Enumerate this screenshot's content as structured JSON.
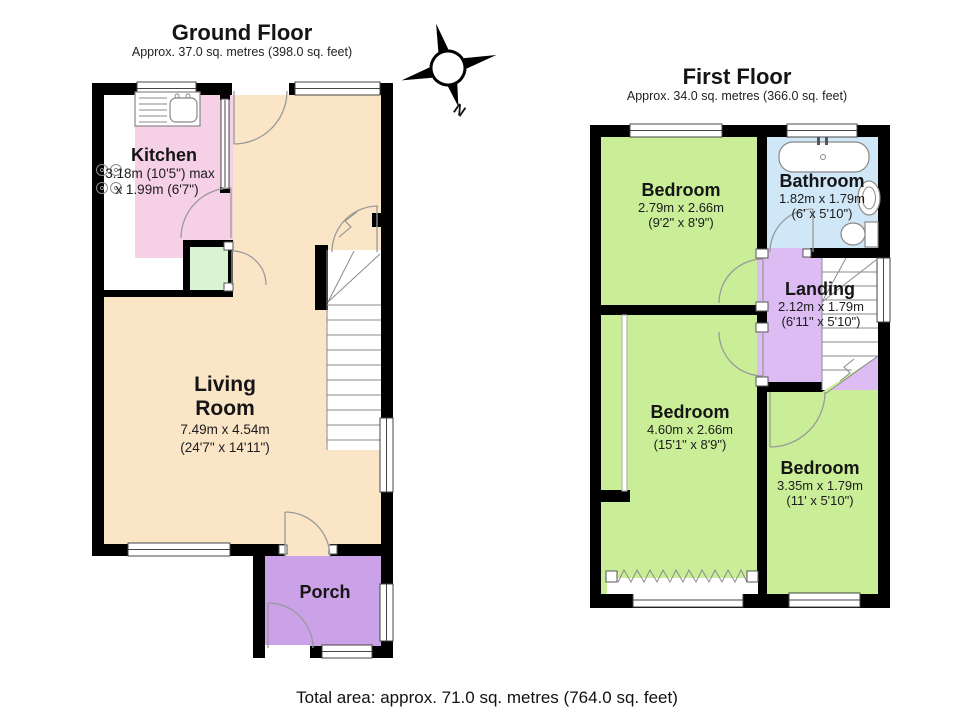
{
  "ground_floor": {
    "title": "Ground Floor",
    "subtitle": "Approx. 37.0 sq. metres (398.0 sq. feet)",
    "kitchen": {
      "name": "Kitchen",
      "dim_metric": "3.18m (10'5\") max",
      "dim_imperial": "x 1.99m (6'7\")"
    },
    "living_room": {
      "name_line1": "Living",
      "name_line2": "Room",
      "dim_metric": "7.49m x 4.54m",
      "dim_imperial": "(24'7\" x 14'11\")"
    },
    "porch": {
      "name": "Porch"
    }
  },
  "first_floor": {
    "title": "First Floor",
    "subtitle": "Approx. 34.0 sq. metres (366.0 sq. feet)",
    "bedroom_front": {
      "name": "Bedroom",
      "dim_metric": "2.79m x 2.66m",
      "dim_imperial": "(9'2\" x 8'9\")"
    },
    "bathroom": {
      "name": "Bathroom",
      "dim_metric": "1.82m x 1.79m",
      "dim_imperial": "(6' x 5'10\")"
    },
    "landing": {
      "name": "Landing",
      "dim_metric": "2.12m x 1.79m",
      "dim_imperial": "(6'11\" x 5'10\")"
    },
    "bedroom_middle": {
      "name": "Bedroom",
      "dim_metric": "4.60m x 2.66m",
      "dim_imperial": "(15'1\" x 8'9\")"
    },
    "bedroom_rear": {
      "name": "Bedroom",
      "dim_metric": "3.35m x 1.79m",
      "dim_imperial": "(11' x 5'10\")"
    }
  },
  "compass": {
    "north_label": "N"
  },
  "footer": {
    "total_area": "Total area: approx. 71.0 sq. metres (764.0 sq. feet)"
  },
  "colors": {
    "wall": "#000000",
    "living_room": "#fbe5c7",
    "kitchen": "#f6d0e6",
    "store": "#d9f4d1",
    "porch": "#cba1e7",
    "bedroom": "#c9ee97",
    "bathroom": "#cfe7f7",
    "landing": "#dcbcf2",
    "floor_white": "#ffffff"
  }
}
